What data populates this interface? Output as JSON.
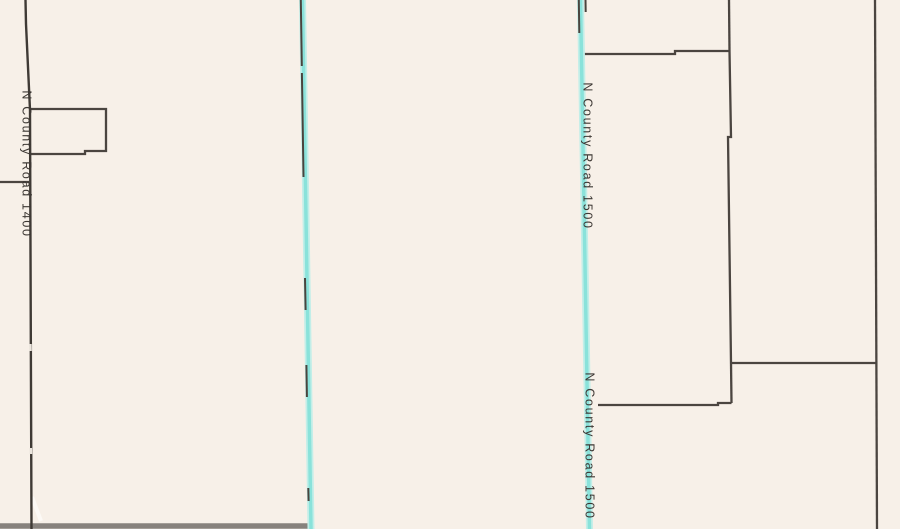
{
  "map": {
    "background_color": "#f7f0e8",
    "parcel_line_color": "#4b4540",
    "road_dark_color": "#3f3a35",
    "road_highlight_glow_color": "#c2eee8",
    "road_highlight_core_color": "#8ae2da",
    "gray_road_color": "#87827d",
    "label_color": "#3d3834",
    "road_labels": [
      {
        "text": "N County Road 1400",
        "x": 22.5,
        "y": 164,
        "rotation": 90
      },
      {
        "text": "N County Road 1500",
        "x": 583.5,
        "y": 156,
        "rotation": 90
      },
      {
        "text": "N County Road 1500",
        "x": 585.5,
        "y": 446,
        "rotation": 90
      }
    ],
    "lines": [
      {
        "name": "gray-road-bottom",
        "color": "#87827d",
        "width": 5.5,
        "points": [
          [
            0,
            526
          ],
          [
            311,
            526
          ]
        ]
      },
      {
        "name": "road-casing-wedge",
        "color": "#fcf9f5",
        "width": 4,
        "points": [
          [
            32,
            497
          ],
          [
            41,
            521
          ]
        ]
      },
      {
        "name": "parcel-outline-west",
        "color": "#4b4540",
        "width": 2.3,
        "points": [
          [
            31,
            109
          ],
          [
            106,
            109
          ],
          [
            106,
            151
          ],
          [
            85,
            151
          ],
          [
            85,
            154
          ],
          [
            30,
            154
          ]
        ]
      },
      {
        "name": "parcel-boundary-west-horizontal",
        "color": "#4b4540",
        "width": 2.3,
        "points": [
          [
            0,
            182
          ],
          [
            29,
            182
          ]
        ]
      },
      {
        "name": "parcel-boundary-topright-vertical-upper",
        "color": "#4b4540",
        "width": 2.3,
        "points": [
          [
            729,
            0
          ],
          [
            729.5,
            51
          ]
        ]
      },
      {
        "name": "parcel-boundary-topright-horizontal",
        "color": "#4b4540",
        "width": 2.3,
        "points": [
          [
            584,
            54
          ],
          [
            675,
            54
          ],
          [
            675,
            51
          ],
          [
            729.5,
            51
          ]
        ]
      },
      {
        "name": "parcel-boundary-topright-vertical-mid",
        "color": "#4b4540",
        "width": 2.3,
        "points": [
          [
            729.5,
            51
          ],
          [
            731,
            137
          ],
          [
            728,
            137
          ],
          [
            731,
            363
          ]
        ]
      },
      {
        "name": "parcel-boundary-midright-horizontal",
        "color": "#4b4540",
        "width": 2.3,
        "points": [
          [
            731,
            363
          ],
          [
            876,
            363
          ]
        ]
      },
      {
        "name": "parcel-boundary-midright-vertical-short",
        "color": "#4b4540",
        "width": 2.3,
        "points": [
          [
            731,
            363
          ],
          [
            731.5,
            403
          ]
        ]
      },
      {
        "name": "parcel-boundary-lowright-horizontal",
        "color": "#4b4540",
        "width": 2.3,
        "points": [
          [
            598,
            405
          ],
          [
            718,
            405
          ],
          [
            718,
            403
          ],
          [
            731.5,
            403
          ]
        ]
      },
      {
        "name": "parcel-boundary-east-vertical-long",
        "color": "#4b4540",
        "width": 2.3,
        "points": [
          [
            875,
            0
          ],
          [
            877,
            529
          ]
        ]
      },
      {
        "name": "road-n-county-1400",
        "color": "#3f3a35",
        "width": 2.4,
        "points": [
          [
            25.5,
            0
          ],
          [
            26,
            24
          ],
          [
            30,
            110
          ],
          [
            31.5,
            529
          ]
        ]
      },
      {
        "name": "road-1400-casing-gap-1",
        "color": "#ebe5dd",
        "width": 2.6,
        "points": [
          [
            30.4,
            344
          ],
          [
            30.5,
            351
          ]
        ]
      },
      {
        "name": "road-1400-casing-gap-2",
        "color": "#ebe5dd",
        "width": 2.6,
        "points": [
          [
            30.8,
            448
          ],
          [
            30.9,
            454
          ]
        ]
      },
      {
        "name": "road-middle-highlight-glow",
        "color": "#c2eee8",
        "width": 7,
        "points": [
          [
            302.5,
            0
          ],
          [
            311,
            529
          ]
        ]
      },
      {
        "name": "road-middle-highlight-core",
        "color": "#8ae2da",
        "width": 3.5,
        "points": [
          [
            302.5,
            0
          ],
          [
            311,
            529
          ]
        ]
      },
      {
        "name": "road-n-county-1500-glow",
        "color": "#c2eee8",
        "width": 7,
        "points": [
          [
            580.5,
            0
          ],
          [
            589.5,
            529
          ]
        ]
      },
      {
        "name": "road-n-county-1500-core",
        "color": "#8ae2da",
        "width": 3.5,
        "points": [
          [
            580.5,
            0
          ],
          [
            589.5,
            529
          ]
        ]
      },
      {
        "name": "parcel-dash-middle-road-1",
        "color": "#4a443e",
        "width": 2,
        "points": [
          [
            300.8,
            0
          ],
          [
            301.8,
            66
          ]
        ]
      },
      {
        "name": "parcel-dash-middle-road-2",
        "color": "#4a443e",
        "width": 2,
        "points": [
          [
            301.9,
            73
          ],
          [
            303.5,
            177
          ]
        ]
      },
      {
        "name": "parcel-dash-middle-road-3",
        "color": "#4a443e",
        "width": 2,
        "points": [
          [
            305,
            278
          ],
          [
            305.6,
            310
          ]
        ]
      },
      {
        "name": "parcel-dash-middle-road-4",
        "color": "#4a443e",
        "width": 2,
        "points": [
          [
            306.4,
            365
          ],
          [
            306.9,
            397
          ]
        ]
      },
      {
        "name": "parcel-dash-middle-road-5",
        "color": "#4a443e",
        "width": 2,
        "points": [
          [
            308.3,
            488
          ],
          [
            308.6,
            501
          ]
        ]
      },
      {
        "name": "parcel-dash-1500-left",
        "color": "#4a443e",
        "width": 2,
        "points": [
          [
            578.8,
            0
          ],
          [
            579.3,
            33
          ]
        ]
      },
      {
        "name": "parcel-dash-1500-right",
        "color": "#4a443e",
        "width": 2,
        "points": [
          [
            585.5,
            0
          ],
          [
            585.7,
            12
          ]
        ]
      }
    ]
  }
}
